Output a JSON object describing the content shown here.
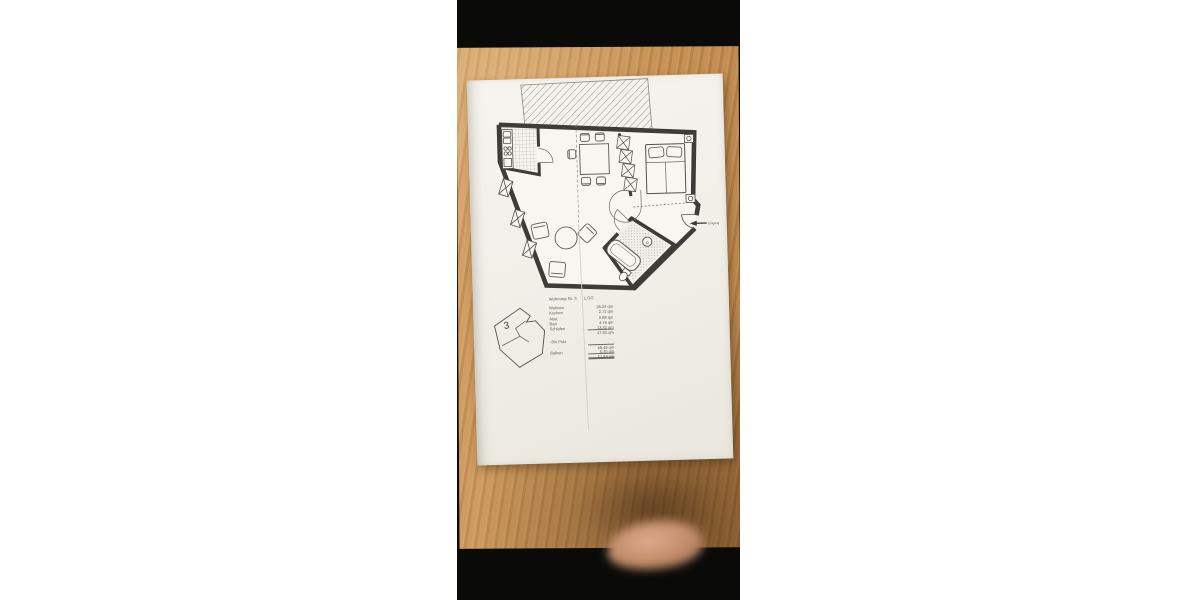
{
  "photo": {
    "description_colors": {
      "background": "#ffffff",
      "photo_black": "#0a0a09",
      "wood": "#c28c4f",
      "paper": "#f3f1ea",
      "ink": "#3f3e3c",
      "skin": "#d3a088"
    }
  },
  "floor_plan": {
    "title": "Wohnung Nr. 3",
    "title_suffix": "1.OG",
    "unit_number": "3",
    "entrance_label": "Eingang",
    "rows": [
      {
        "label": "Wohnen",
        "value": "26.24 qm"
      },
      {
        "label": "Kochen",
        "value": "2.72 qm"
      },
      {
        "label": "Abst.",
        "value": "0.88 qm"
      },
      {
        "label": "Bad",
        "value": "4.76 qm"
      },
      {
        "label": "Schlafen",
        "value": "13.32 qm"
      },
      {
        "label": "",
        "value": "47.92 qm"
      },
      {
        "label": "-3% Putz",
        "value": ""
      },
      {
        "label": "",
        "value": "46.49 qm"
      },
      {
        "label": "Balkon",
        "value": "5.35 qm"
      },
      {
        "label": "",
        "value": "51.84 qm"
      }
    ]
  }
}
